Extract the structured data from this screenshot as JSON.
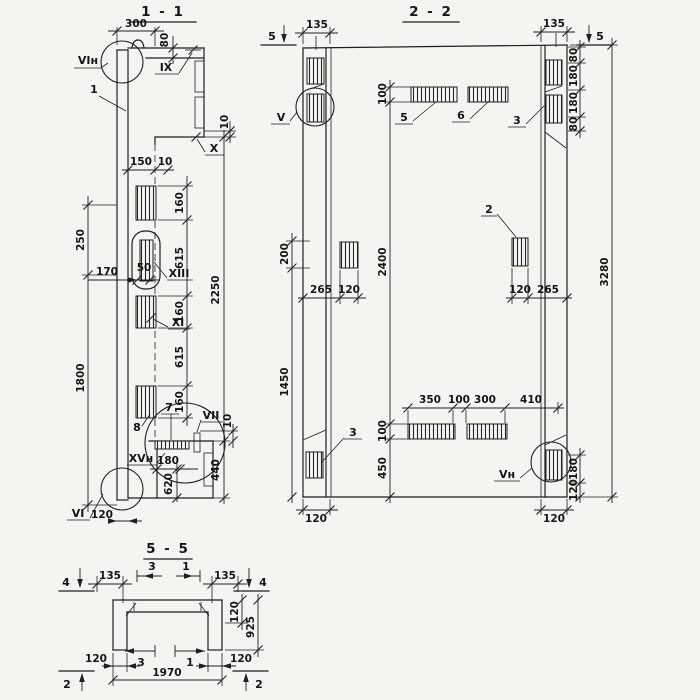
{
  "s11": {
    "title": "1 - 1",
    "callouts": {
      "n1": "1",
      "n7": "7",
      "n8": "8"
    },
    "marks": {
      "vin": "VIн",
      "ix": "IX",
      "x": "X",
      "xiii": "XIII",
      "xi": "XI",
      "vii": "VII",
      "xvn": "XVн",
      "vi": "VI"
    },
    "dims": {
      "w300": "300",
      "h80": "80",
      "h10top": "10",
      "w150": "150",
      "w10": "10",
      "chain": [
        "160",
        "615",
        "160",
        "615",
        "160"
      ],
      "v2250": "2250",
      "v440": "440",
      "v10": "10",
      "l250": "250",
      "l1800": "1800",
      "w170": "170",
      "w50": "50",
      "b180": "180",
      "b620": "620",
      "b120": "120"
    }
  },
  "s22": {
    "title": "2 - 2",
    "callouts": {
      "n2": "2",
      "n3top": "3",
      "n3bot": "3",
      "n5": "5",
      "n6": "6"
    },
    "marks": {
      "v": "V",
      "vn": "Vн",
      "cut5l": "5",
      "cut5r": "5"
    },
    "dims": {
      "t135l": "135",
      "t135r": "135",
      "rchain": [
        "80",
        "180",
        "180",
        "80"
      ],
      "v3280": "3280",
      "r180": "180",
      "r120": "120",
      "c100t": "100",
      "c2400": "2400",
      "c100b": "100",
      "c450": "450",
      "l200": "200",
      "l1450": "1450",
      "m265l": "265",
      "m120l": "120",
      "m120r": "120",
      "m265r": "265",
      "row": [
        "350",
        "100",
        "300",
        "410"
      ],
      "b120l": "120",
      "b120r": "120"
    }
  },
  "s55": {
    "title": "5 - 5",
    "marks": {
      "cut4l": "4",
      "cut4r": "4",
      "cut2l": "2",
      "cut2r": "2"
    },
    "bars": {
      "t3": "3",
      "t1": "1",
      "b3": "3",
      "b1": "1"
    },
    "dims": {
      "t135l": "135",
      "t135r": "135",
      "v120": "120",
      "v925": "925",
      "b120l": "120",
      "b120r": "120",
      "w1970": "1970"
    }
  }
}
